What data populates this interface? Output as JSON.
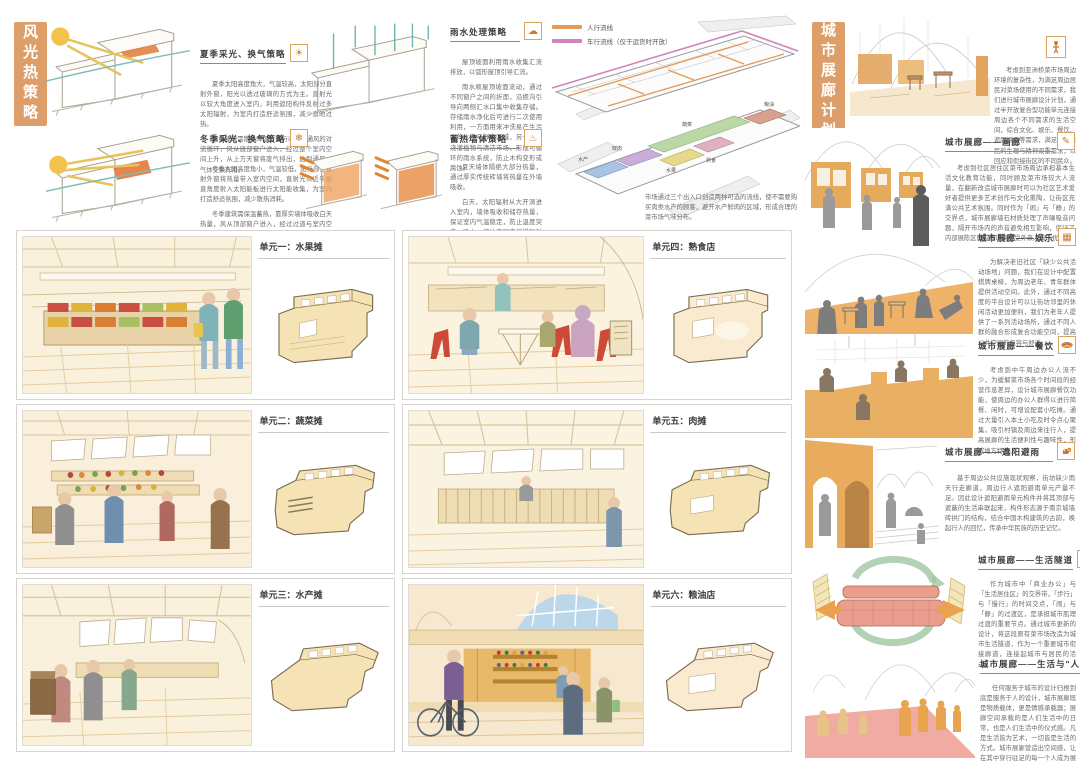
{
  "poster": {
    "left": {
      "title": "风光热策略",
      "sections": [
        {
          "heading": "夏季采光、换气策略",
          "icon": "summer-sun",
          "icon_glyph": "☀",
          "p1": "夏季太阳高度角大，气温较高，太阳部分直射外窗，阳光以透过玻璃的方式为主。直射光以较大角度进入室内，利用遮阳构件反射过多太阳辐射，为室内打造舒适氛围，减少直晒过热。",
          "p2": "夏季建筑需散热降温，进行以热压通风的对流循环，风从底部窗户进入，经过整个室内空间上升，从上方天窗将废气排出，达到通风、气体交换作用。"
        },
        {
          "heading": "冬季采光、换气策略",
          "icon": "winter-snowflake",
          "icon_glyph": "❄",
          "p1": "冬季太阳高度角小，气温较低，阳光部分直射外窗将热量带入室内空间，直射光以近乎垂直角度射入太阳能板进行太阳能收集，为室内打造舒适氛围，减少散热消耗。",
          "p2": "冬季建筑需保温蓄热，靠厚实墙体吸收白天热量，风从顶部窗户进入，经过过道与室内空间缓慢交换，从上方天窗将废气排出，在保证通风的同时减少不必要的室内热量散失。"
        },
        {
          "heading": "雨水处理策略",
          "icon": "rain-cloud",
          "icon_glyph": "☁",
          "p1": "屋顶坡面利用雨水收集汇流排放，以弧形屋顶引导汇流。",
          "p2": "雨水顺屋顶坡面流动，通过不同窗户之间的折面，沿檐沟引导向两侧汇水口集中收集存储。存储雨水净化后可进行二次使用利用，一方面用来冲洗易产生污水的水产与鲜肉区域，另一方面浇灌植物与清洁市场，形成可循环的雨水系统，防止木构变形或腐蚀。"
        },
        {
          "heading": "蓄热墙体策略",
          "icon": "heat-wall",
          "icon_glyph": "♨",
          "p1": "夏天墙体隔绝大部分热量，通过厚实传统砖墙将热量在外墙吸收。",
          "p2": "白天，太阳辐射从大开洞进入室内，墙体吸收和储存热量，保证室内气温稳定，防止温度突变；晚上，墙体向室内缓慢辐射散热，为室内提供稳定的保温效果，防止室内外温差突变，维持室内气温稳定变化。"
        }
      ]
    },
    "axon": {
      "legend": [
        {
          "label": "人行流线",
          "color": "#e29a56"
        },
        {
          "label": "车行流线（仅于运货时开放）",
          "color": "#cf84bd"
        }
      ],
      "zones": [
        {
          "label": "水产",
          "color": "#a9c3e2"
        },
        {
          "label": "鲜肉",
          "color": "#c9aedb"
        },
        {
          "label": "蔬菜",
          "color": "#b9d8a6"
        },
        {
          "label": "水果",
          "color": "#e6d98c"
        },
        {
          "label": "熟食",
          "color": "#e0b1be"
        },
        {
          "label": "粮油及杂货",
          "color": "#d8a08f"
        }
      ],
      "caption": "市场通过三个出入口创造两种可选的流线，使不需要购买肉类水产的顾客，避开水产鲜肉的区域，形成合理的菜市场气味分布。"
    },
    "units": [
      {
        "label": "单元一：水果摊"
      },
      {
        "label": "单元四：熟食店"
      },
      {
        "label": "单元二：蔬菜摊"
      },
      {
        "label": "单元五：肉摊"
      },
      {
        "label": "单元三：水产摊"
      },
      {
        "label": "单元六：粮油店"
      }
    ],
    "right": {
      "title": "城市展廊计划",
      "intro": {
        "icon": "exhibit-person",
        "text": "考虑到亚洲桥菜市场周边环境的复杂性，为满足周边居民对菜场使用的不同需求，我们进行城市展廊设计计划，通过半开放复合型功能单元连接周边各个不同需求的生活空间，综合文化、娱乐、餐饮、遮阳避雨等需求，满足周边居民的生理与精神双重需求，以回应和衔接街区的不同民众。"
      },
      "sections": [
        {
          "heading": "城市展廊——画廊",
          "icon": "pencil",
          "icon_glyph": "✎",
          "text": "考虑到社区居住区菜市场周边承担基本生活文化教育功能，同时顾及菜市场较大人流量，在翻新改造城市展廊时可以为社区艺术爱好者提供更多艺术创作与文化熏陶，让街区充满公共艺术氛围。同时作为「闹」与「静」的交界点，城市展廊墙石材质处理了声噪吸音问题，隔开市场内的声音避免相互影响，保证了内部展陈区的宜静环境不受外来人流干扰。"
        },
        {
          "heading": "城市展廊——娱乐",
          "icon": "mahjong-tiles",
          "icon_glyph": "▦",
          "text": "为解决老旧社区「缺少公共活动场地」问题，我们在设计中配置棋牌桌椅，为周边老年、青年群体提供活动空间。此外，通过不同高度的平台设计可以让街坊邻里的休闲活动更加便利，我们为老年人提供了一系列活动场所，通过不同人群的融合形成复合功能空间，提高公共空间的包容与舒适。"
        },
        {
          "heading": "城市展廊——餐饮",
          "icon": "snack",
          "icon_glyph": "",
          "text": "考虑到中午周边办公人流不少，为缓解菜市场各个时间段的经营作息差异，设计城市展廊餐饮功能，使周边的办公人群得以进行简餐、闲时，可增设配套小吃摊。通过大量引入本土小吃及时令点心聚集，吸引村镇及周边来往行人，提高展廊的生活便利性与趣味性，形成地方特色。"
        },
        {
          "heading": "城市展廊——遮阳避雨",
          "icon": "squirrel",
          "icon_glyph": "",
          "text": "基于周边公共设施现状观察，街坊缺少雨天行走廊道，周边行人遮阳避雨单元产量不足。因此设计遮阳避雨单元构件并将其顶部与遮蔽的生活串联起来，构件形态源于南京城墙砖拱门的结构，结合中国木构建筑的古韵，唤起行人的回忆，传承中华民族的历史记忆。"
        },
        {
          "heading": "城市展廊——生活隧道",
          "icon": "circular-arrows",
          "icon_glyph": "↻",
          "text": "作为城市中「商业办公」与「生活居住区」的交界带，「步行」与「慢行」的时间交点，「闹」与「静」的过渡区，是承担城市肌理过渡的重要节点。通过城市更新的设计，将这段原有菜市场改造为城市生活隧道，作为一个重要城市衔接廊道，连接起城市与居民的活动。"
        },
        {
          "heading": "城市展廊——生活与\"人\"",
          "icon": "camera",
          "icon_glyph": "",
          "text": "任何服务于城市的设计归根到底是服务于人的设计，城市展廊既是物质载体，更是情感承载器；展廊空间承载的是人们生活中的日常，也是人们生活中的仪式感。凡是生活皆为艺术，一切皆是生活的方式。城市展廊营造出空间感，让在其中穿行驻足的每一个人成为展览的主角，让城市充满对生活的热爱与记录，每个平凡的时刻都是生活中的印记。"
        }
      ]
    }
  }
}
